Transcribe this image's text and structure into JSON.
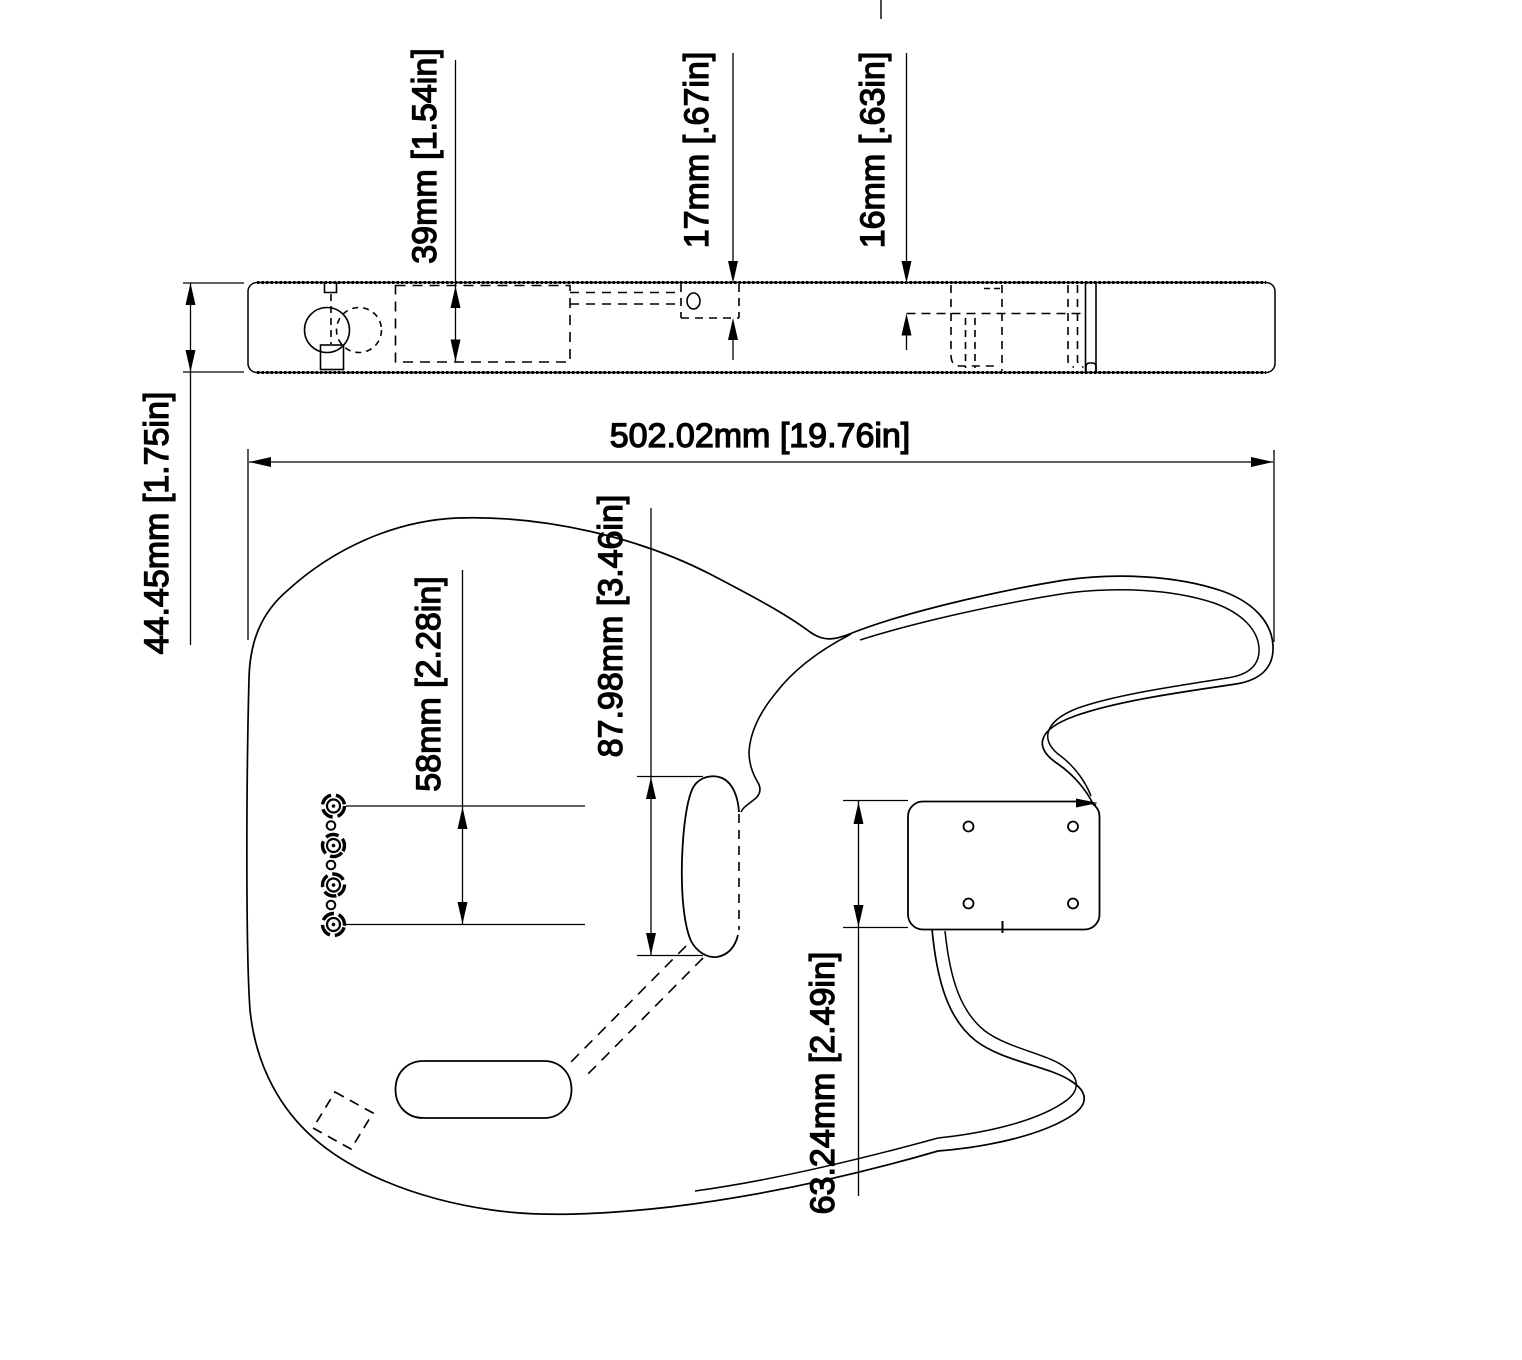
{
  "drawing": {
    "background": "#ffffff",
    "line_color": "#000000",
    "dimensions": {
      "cavity_depth": {
        "label": "39mm [1.54in]"
      },
      "neck_pocket_depth": {
        "label": "17mm [.67in]"
      },
      "bridge_recess_depth": {
        "label": "16mm [.63in]"
      },
      "body_thickness": {
        "label": "44.45mm [1.75in]"
      },
      "body_length": {
        "label": "502.02mm [19.76in]"
      },
      "ferrule_spacing": {
        "label": "58mm [2.28in]"
      },
      "neck_pocket_length": {
        "label": "87.98mm [3.46in]"
      },
      "bridge_plate_height": {
        "label": "63.24mm [2.49in]"
      }
    }
  }
}
